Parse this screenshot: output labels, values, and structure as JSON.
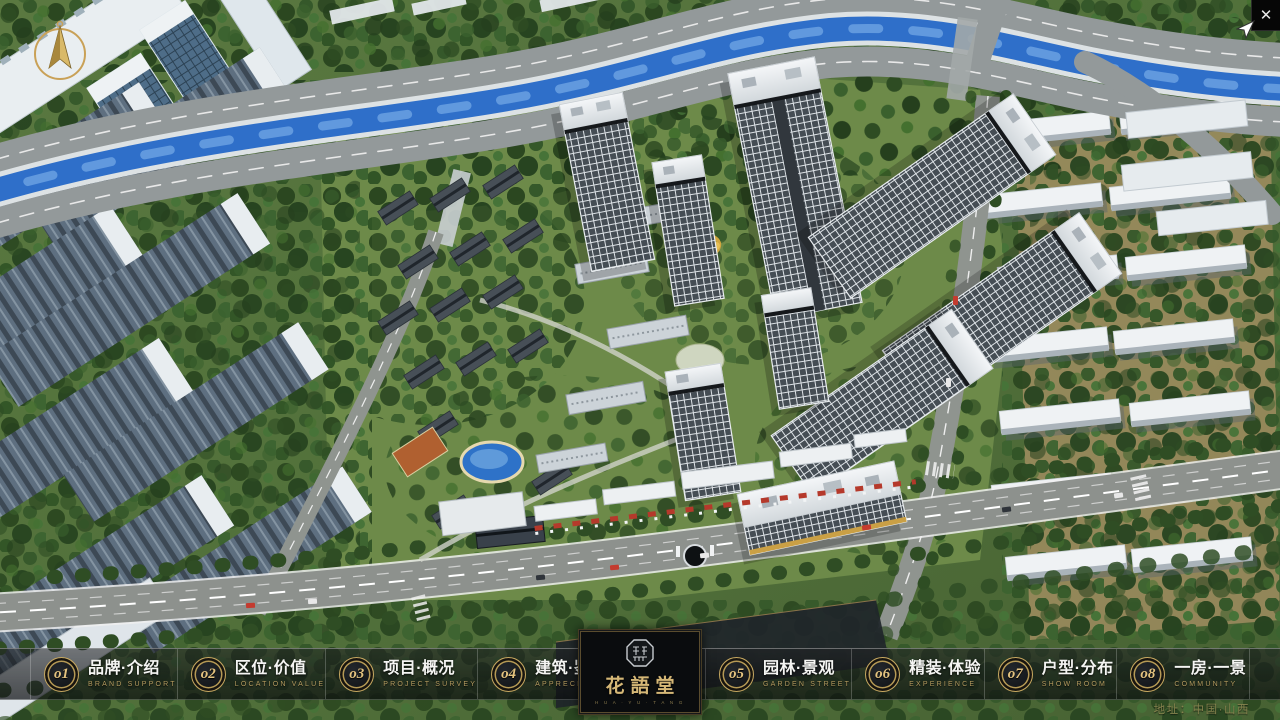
{
  "window": {
    "close_glyph": "✕"
  },
  "menu": {
    "items": [
      {
        "num": "o1",
        "title": "品牌·介绍",
        "subtitle": "BRAND SUPPORT"
      },
      {
        "num": "o2",
        "title": "区位·价值",
        "subtitle": "LOCATION VALUE"
      },
      {
        "num": "o3",
        "title": "项目·概况",
        "subtitle": "PROJECT SURVEY"
      },
      {
        "num": "o4",
        "title": "建筑·鉴赏",
        "subtitle": "APPRECIATION"
      },
      {
        "num": "o5",
        "title": "园林·景观",
        "subtitle": "GARDEN STREET"
      },
      {
        "num": "o6",
        "title": "精装·体验",
        "subtitle": "EXPERIENCE"
      },
      {
        "num": "o7",
        "title": "户型·分布",
        "subtitle": "SHOW ROOM"
      },
      {
        "num": "o8",
        "title": "一房·一景",
        "subtitle": "COMMUNITY"
      }
    ]
  },
  "logo": {
    "title": "花語堂",
    "caption": "H U A · Y U · T A N G"
  },
  "footer": {
    "address": "地址：中国·山西"
  },
  "colors": {
    "accent_gold": "#c7a860",
    "bar_bg": "rgba(10,12,14,0.66)",
    "river": "#2f6fc9"
  }
}
